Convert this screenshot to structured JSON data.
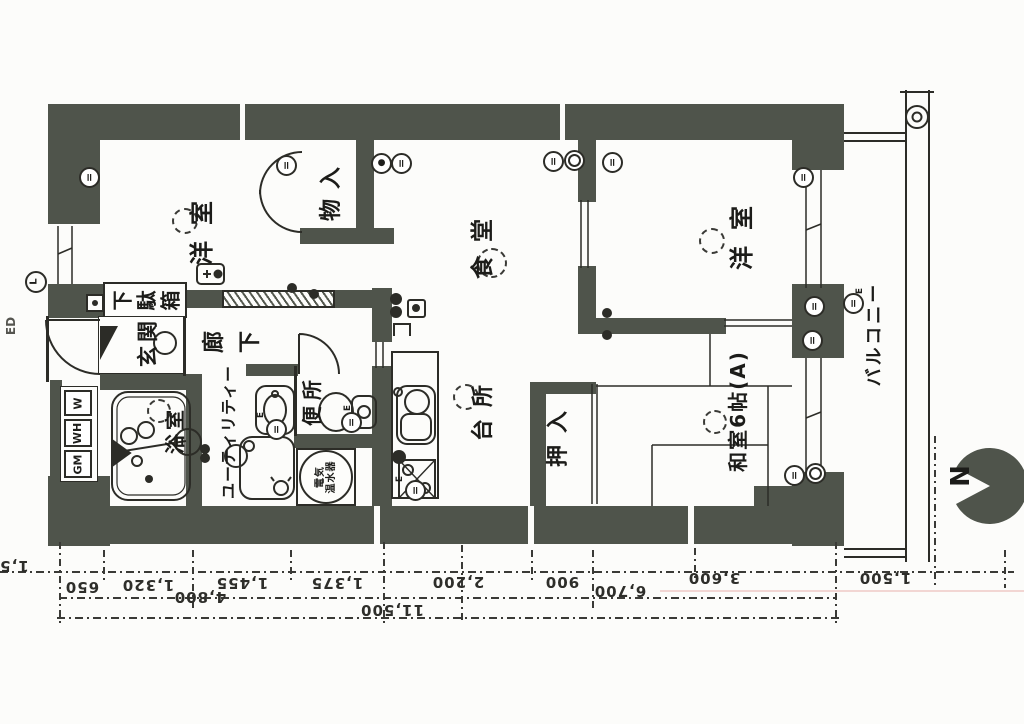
{
  "labels": {
    "room_west1": "洋室",
    "room_west2": "洋室",
    "storage": "物入",
    "dining": "食堂",
    "kitchen": "台所",
    "balcony": "バルコニー",
    "entrance": "玄関",
    "hallway": "廊下",
    "utility": "ユーティリティー",
    "toilet": "便所",
    "bath": "浴室",
    "closet": "押入",
    "tatami": "和室6帖(A)",
    "shoe_cabinet": "下駄箱",
    "water_heater_l1": "電気",
    "water_heater_l2": "温水器",
    "meter_w": "W",
    "meter_wh": "WH",
    "meter_gm": "GM",
    "edge_fragment": "ED"
  },
  "compass": {
    "north": "N"
  },
  "icons": {
    "outlet_bars": "=",
    "light_solid": "●",
    "earth": "E",
    "switch_plus": "+",
    "lamp_l": "L"
  },
  "dimensions": {
    "row1": [
      "650",
      "1,320",
      "1,455",
      "1,375",
      "2,200",
      "900",
      "3,600"
    ],
    "row2": [
      "4,800",
      "6,700"
    ],
    "total": "11,500",
    "balcony_depth": "1,500",
    "left_fragment": "1,5"
  }
}
